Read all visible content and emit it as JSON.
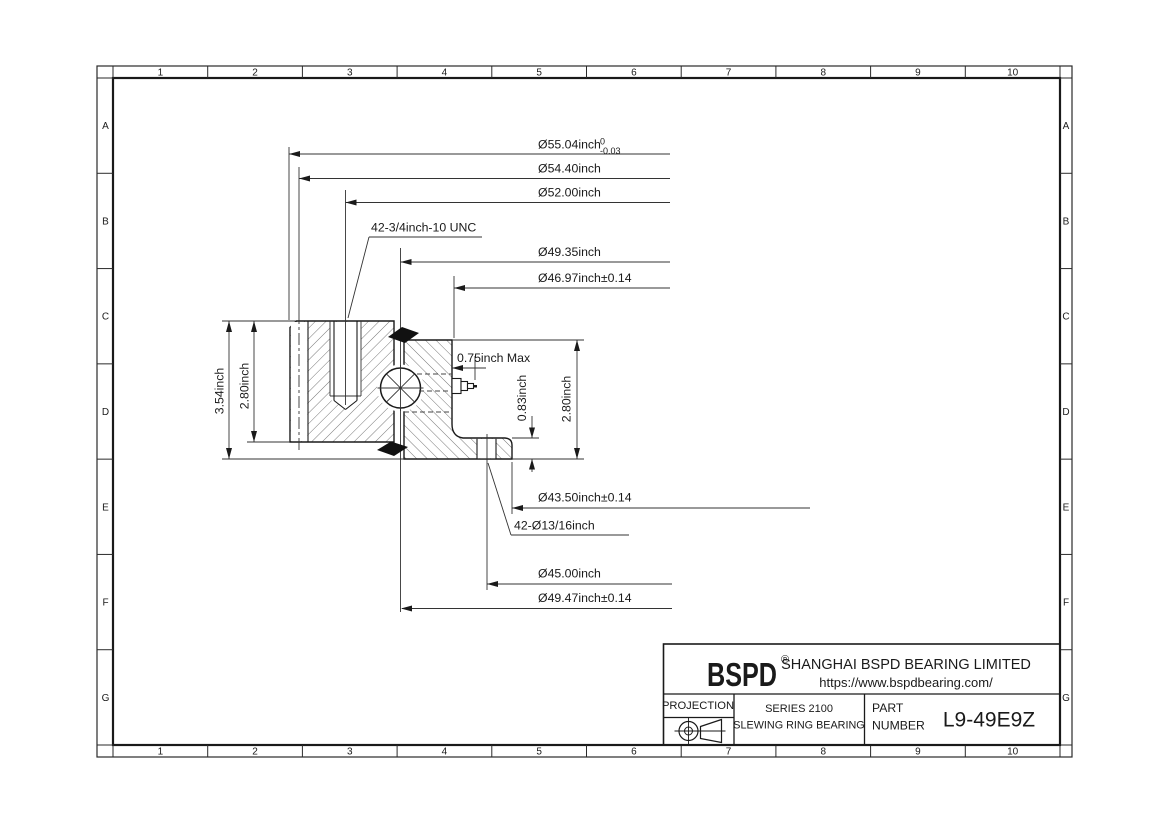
{
  "colors": {
    "ink": "#1a1a1a",
    "background": "#ffffff"
  },
  "grid": {
    "cols": [
      "1",
      "2",
      "3",
      "4",
      "5",
      "6",
      "7",
      "8",
      "9",
      "10"
    ],
    "rows": [
      "A",
      "B",
      "C",
      "D",
      "E",
      "F",
      "G"
    ]
  },
  "dims": {
    "od_main": "Ø55.04inch",
    "od_tol_sup": "0",
    "od_tol_sub": "-0.03",
    "od_step": "Ø54.40inch",
    "bolt_circle_outer": "Ø52.00inch",
    "thread": "42-3/4inch-10 UNC",
    "raceway_upper": "Ø49.35inch",
    "bore_upper": "Ø46.97inch±0.14",
    "height_overall": "3.54inch",
    "height_outer_ring": "2.80inch",
    "grease_protrusion": "0.75inch Max",
    "flange_height": "0.83inch",
    "height_inner_ring": "2.80inch",
    "flange_bore": "Ø43.50inch±0.14",
    "mounting_holes": "42-Ø13/16inch",
    "bolt_circle_inner": "Ø45.00inch",
    "raceway_lower": "Ø49.47inch±0.14"
  },
  "title_block": {
    "logo": "BSPD",
    "reg_mark": "®",
    "company": "SHANGHAI BSPD BEARING LIMITED",
    "website": "https://www.bspdbearing.com/",
    "projection_label": "PROJECTION",
    "series_line1": "SERIES 2100",
    "series_line2": "SLEWING RING BEARING",
    "part_label_line1": "PART",
    "part_label_line2": "NUMBER",
    "part_number": "L9-49E9Z"
  }
}
